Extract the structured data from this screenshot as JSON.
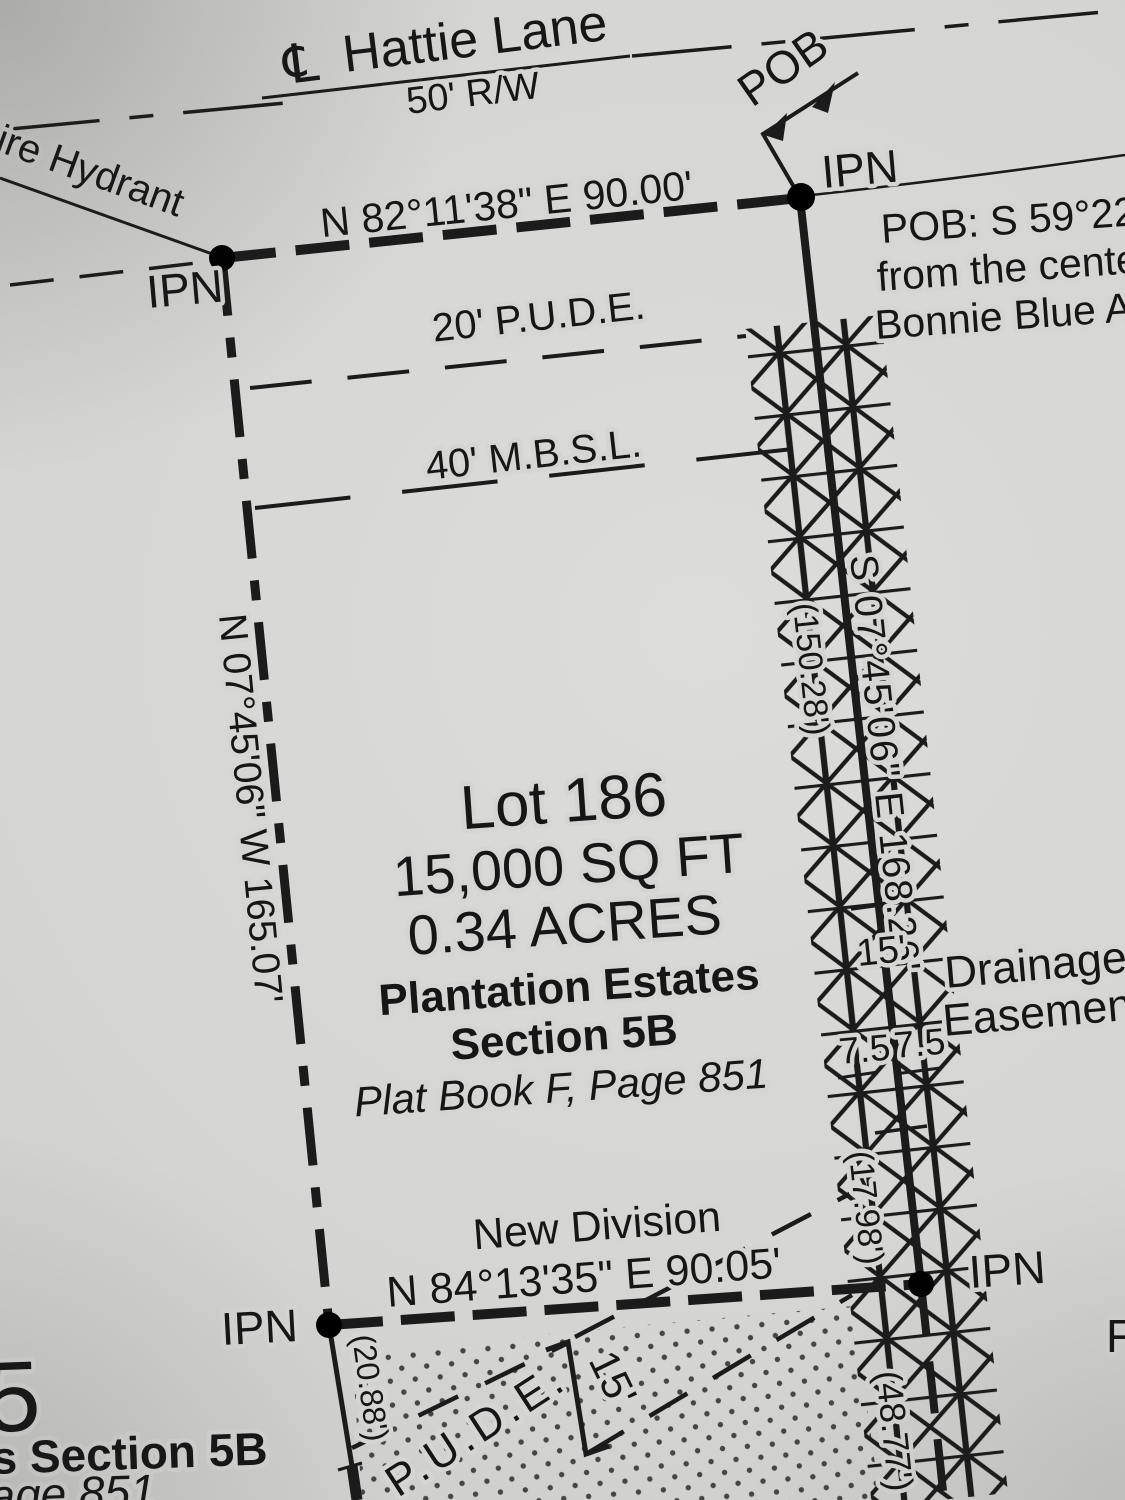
{
  "colors": {
    "paper": "#d4d4d2",
    "ink": "#1b1b1b"
  },
  "road": {
    "centerline_symbol": "℄",
    "name": "Hattie Lane",
    "right_of_way": "50' R/W"
  },
  "pob": {
    "label": "POB",
    "note_line1": "POB: S 59°22'5",
    "note_line2": "from the center",
    "note_line3": "Bonnie Blue Av"
  },
  "markers": {
    "top_left": "IPN",
    "top_right": "IPN",
    "bottom_left": "IPN",
    "bottom_right": "IPN"
  },
  "boundaries": {
    "north_bearing": "N 82°11'38\" E  90.00'",
    "west_bearing": "N 07°45'06\" W  165.07'",
    "east_bearing": "S 07°45'06\" E  168.26'",
    "east_tie_upper": "(150.28')",
    "east_tie_lower": "(17.98')",
    "east_tie_below": "(48.77')",
    "south_name": "New Division",
    "south_bearing": "N 84°13'35\" E  90.05'",
    "west_extension_tie": "(20.88')"
  },
  "lot": {
    "number": "Lot 186",
    "area_sqft": "15,000 SQ FT",
    "area_acres": "0.34 ACRES",
    "subdivision": "Plantation Estates",
    "section": "Section 5B",
    "plat_reference": "Plat Book F, Page 851"
  },
  "easements": {
    "pude_20": "20' P.U.D.E.",
    "mbsl_40": "40' M.B.S.L.",
    "drainage_width": "15'",
    "drainage_label_line1": "Drainage",
    "drainage_label_line2": "Easement",
    "drainage_half_left": "7.5",
    "drainage_half_right": "7.5",
    "pude_south_label": "P.U.D.E.",
    "pude_south_width": "15'"
  },
  "annotations": {
    "fire_hydrant_partial": "ire Hydrant"
  },
  "edge_fragments": {
    "adjacent_lot_number": "5",
    "adjacent_section": "s Section 5B",
    "adjacent_plat_page": "age 851",
    "right_edge_letter": "F"
  }
}
